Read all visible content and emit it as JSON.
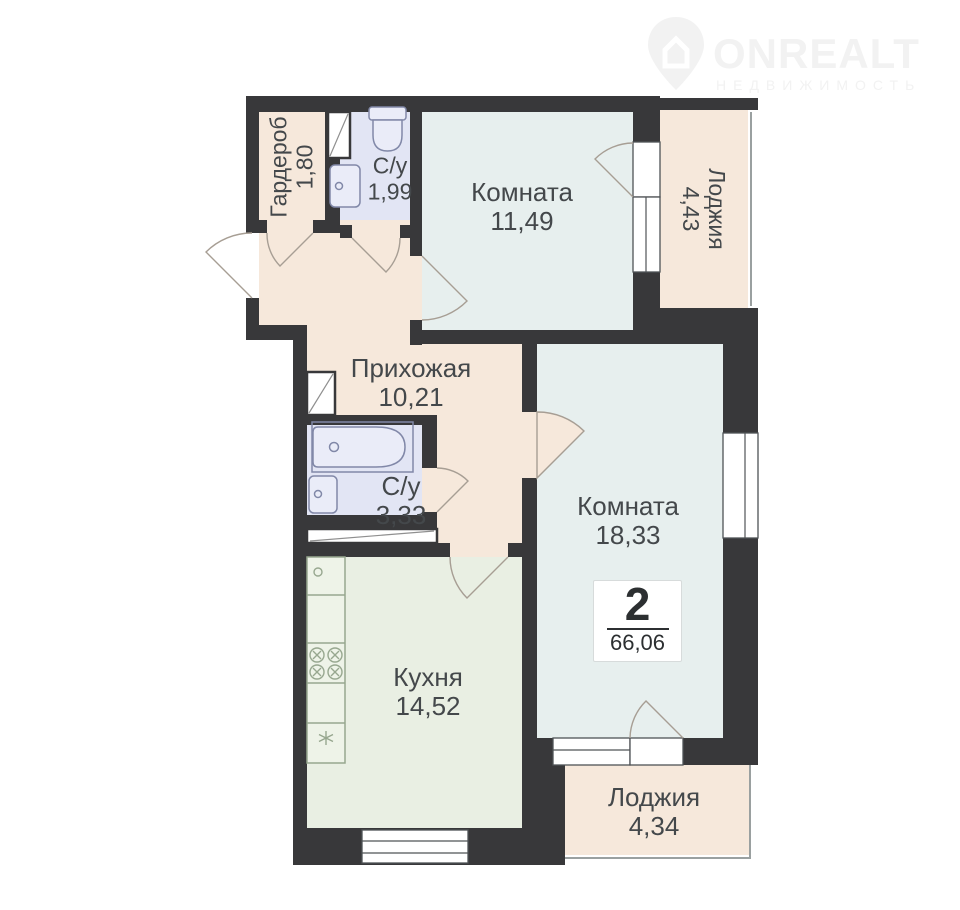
{
  "logo": {
    "brand": "ONREALT",
    "tagline": "НЕДВИЖИМОСТЬ"
  },
  "plan": {
    "type_badge": {
      "rooms": "2",
      "total_area": "66,06"
    },
    "rooms": [
      {
        "id": "wardrobe",
        "name": "Гардероб",
        "area": "1,80"
      },
      {
        "id": "bathroom-small",
        "name": "С/у",
        "area": "1,99"
      },
      {
        "id": "room-1",
        "name": "Комната",
        "area": "11,49"
      },
      {
        "id": "loggia-top",
        "name": "Лоджия",
        "area": "4,43"
      },
      {
        "id": "hallway",
        "name": "Прихожая",
        "area": "10,21"
      },
      {
        "id": "bathroom-large",
        "name": "С/у",
        "area": "3,33"
      },
      {
        "id": "room-2",
        "name": "Комната",
        "area": "18,33"
      },
      {
        "id": "kitchen",
        "name": "Кухня",
        "area": "14,52"
      },
      {
        "id": "loggia-bottom",
        "name": "Лоджия",
        "area": "4,34"
      }
    ],
    "colors": {
      "wall": "#38383a",
      "hall": "#f6e8db",
      "wet": "#e2e5f4",
      "room": "#e7efee",
      "kitchen": "#e9efe3",
      "text": "#44484b",
      "logo": "#f2f2f2",
      "arc": "#a79e94",
      "window": "#4f5356",
      "glazing": "#9aa0a0",
      "wetfix": "#8188a8",
      "wetfill": "#eaecf8",
      "kitfix": "#97a78f",
      "kitfill": "#eef3e8",
      "badge_border": "#d7dbdb"
    }
  }
}
